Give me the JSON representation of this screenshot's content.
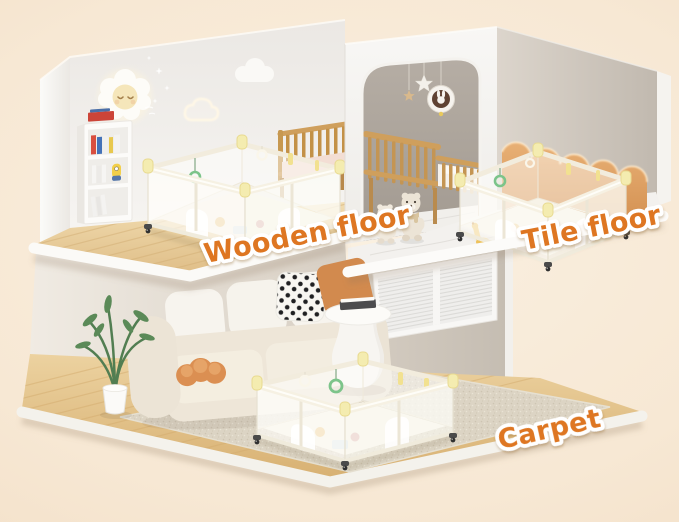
{
  "rooms": [
    {
      "name": "nursery-wooden-floor",
      "floor_label": "Wooden floor"
    },
    {
      "name": "kids-bedroom-tile-floor",
      "floor_label": "Tile floor"
    },
    {
      "name": "living-room-carpet",
      "floor_label": "Carpet"
    }
  ],
  "palette": {
    "background_peach": "#F6E5CF",
    "label_fill_orange": "#DE7620",
    "label_outline_white": "#FFFFFF",
    "wood_floor_tan": "#E3C28E",
    "tile_floor_white": "#F3F1EE",
    "carpet_beige": "#DCD5C6",
    "headboard_caramel": "#DA9A5C",
    "wall_taupe": "#C9C1B7",
    "playpen_frame_cream": "#F4EFE3",
    "playpen_cap_yellow": "#F3E9B2",
    "ring_toy_green": "#7CC48A",
    "pillow_orange": "#D28A4E",
    "crib_wood_oak": "#C6974F"
  }
}
